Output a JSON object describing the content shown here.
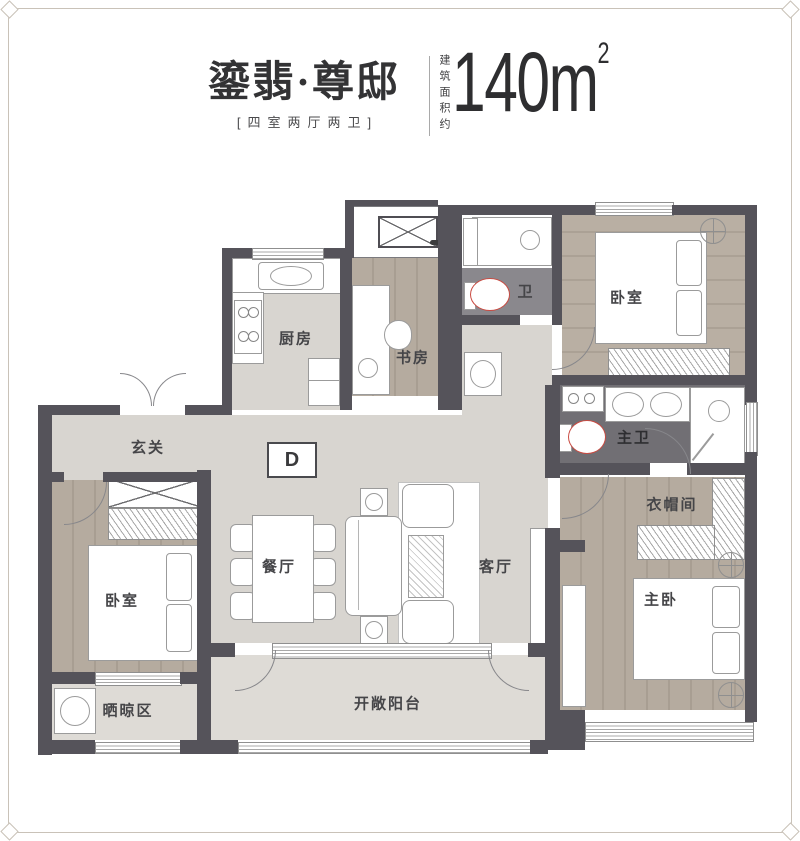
{
  "header": {
    "title": "鎏翡·尊邸",
    "subtitle": "[四室两厅两卫]",
    "area_label": "建筑面积约",
    "area_value": "140m",
    "area_sup": "2"
  },
  "plan": {
    "unit_type": "D",
    "rooms": {
      "entry": "玄关",
      "kitchen": "厨房",
      "study": "书房",
      "bath": "卫",
      "bedroom_top": "卧室",
      "master_bath": "主卫",
      "cloakroom": "衣帽间",
      "master_bedroom": "主卧",
      "bedroom_left": "卧室",
      "dining": "餐厅",
      "living": "客厅",
      "drying": "晒晾区",
      "balcony": "开敞阳台"
    }
  },
  "colors": {
    "wall": "#55535a",
    "stone_floor": "#d8d5d0",
    "balcony_floor": "#dedbd6",
    "wood_floor": "#b2a89c",
    "bath_tile": "#8a888d",
    "master_bath_tile": "#716f74",
    "toilet_accent": "#c94b42",
    "frame": "#c9c2b8",
    "text": "#3c3c3e"
  }
}
